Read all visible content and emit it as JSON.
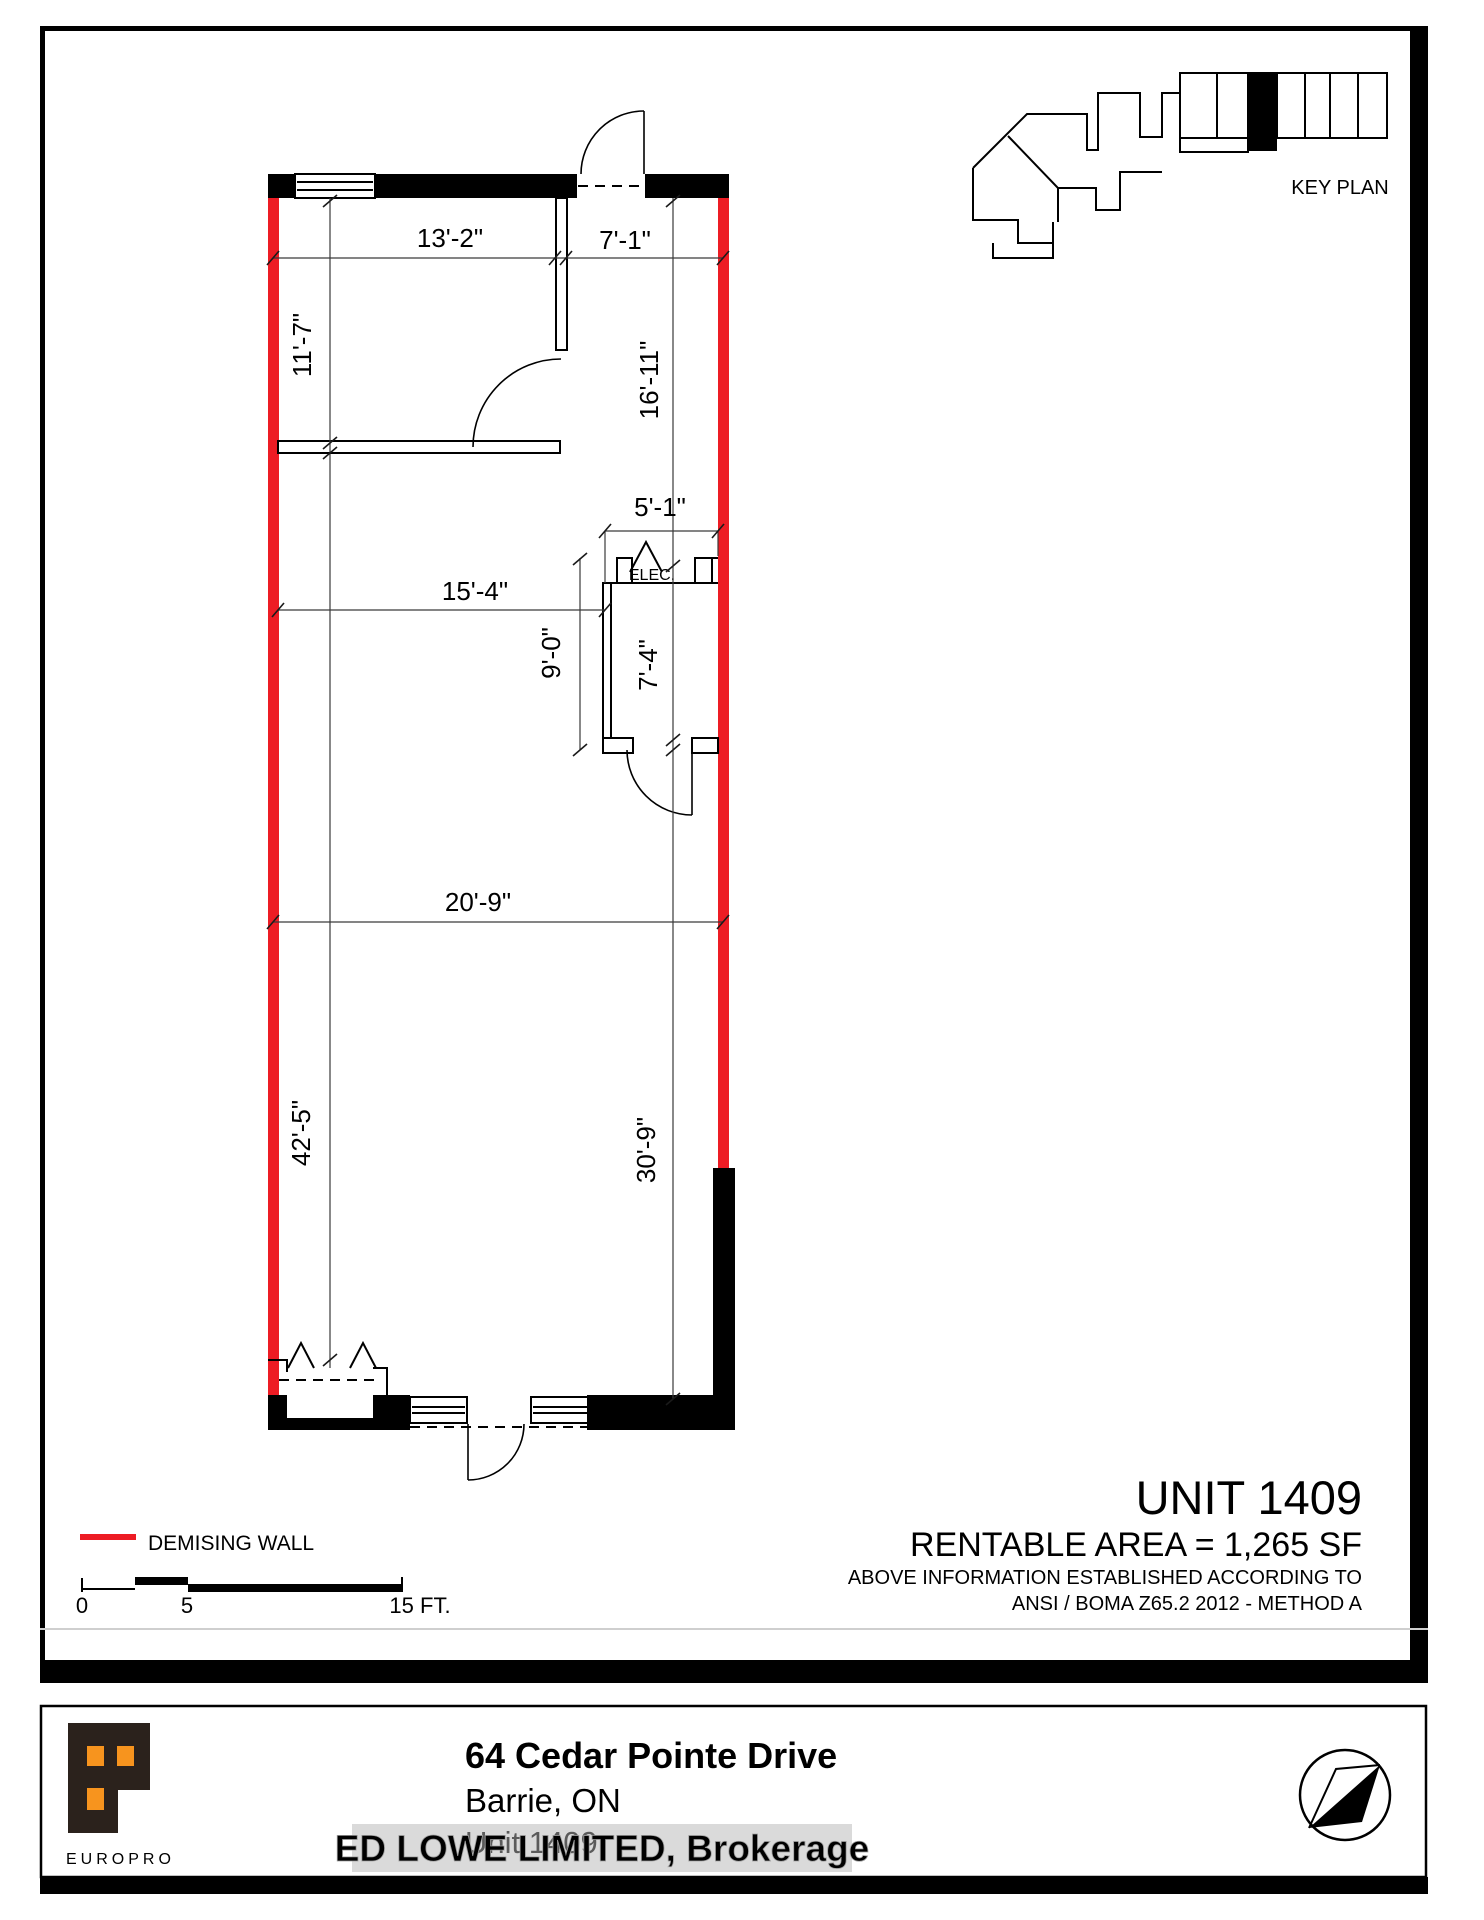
{
  "colors": {
    "demising_red": "#ed1c24",
    "logo_orange": "#f7941e",
    "logo_dark": "#2b221c"
  },
  "key_plan": {
    "label": "KEY PLAN"
  },
  "plan": {
    "elec_label": "ELEC.",
    "dims": {
      "top_left_width": "13'-2\"",
      "top_right_width": "7'-1\"",
      "upper_room_depth": "11'-7\"",
      "right_upper_depth": "16'-11\"",
      "elec_width": "5'-1\"",
      "mid_width": "15'-4\"",
      "elec_outer_depth": "9'-0\"",
      "elec_inner_depth": "7'-4\"",
      "lower_width": "20'-9\"",
      "left_depth": "42'-5\"",
      "right_lower_depth": "30'-9\""
    }
  },
  "title_block": {
    "unit": "UNIT 1409",
    "area": "RENTABLE AREA = 1,265 SF",
    "note_line1": "ABOVE INFORMATION ESTABLISHED ACCORDING TO",
    "note_line2": "ANSI / BOMA Z65.2 2012 - METHOD A"
  },
  "legend": {
    "demising_wall_label": "DEMISING WALL"
  },
  "scale_bar": {
    "zero_label": "0",
    "five_label": "5",
    "fifteen_label": "15 FT."
  },
  "date_strip": {
    "date": "April 19, 2016",
    "copyright": "© 2016 Space Database Inc. All Rights Reserved"
  },
  "footer": {
    "brand": "EUROPRO",
    "address_line1": "64 Cedar Pointe Drive",
    "address_line2": "Barrie, ON",
    "address_line3": "Unit 1409",
    "watermark": "ED LOWE LIMITED, Brokerage"
  }
}
